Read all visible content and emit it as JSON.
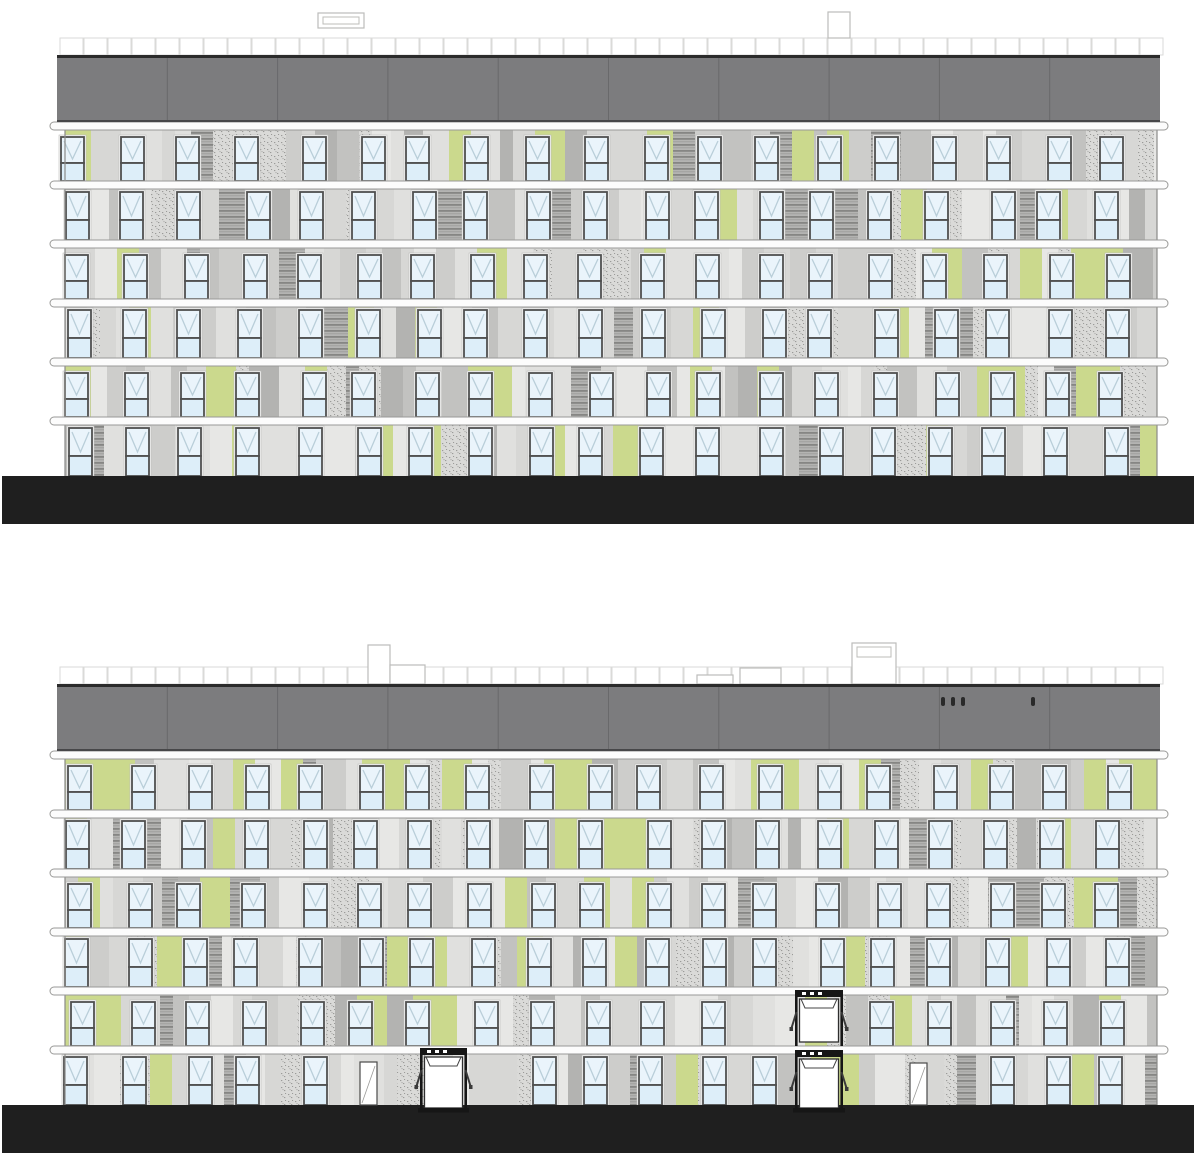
{
  "canvas": {
    "width": 1200,
    "height": 1166,
    "background": "#ffffff"
  },
  "colors": {
    "roof_fill": "#7c7c7e",
    "roof_top_edge": "#2b2b2b",
    "roof_seam": "#69696b",
    "roof_bottom_edge": "#474749",
    "slab_fill": "#fcfcfc",
    "slab_stroke": "#999997",
    "facade_base": "#dcdcda",
    "facade_edge": "#8a8a88",
    "panel_grays": [
      "#e7e7e5",
      "#e0e0de",
      "#d7d7d5",
      "#cdcdcb",
      "#c2c2c0",
      "#b3b3b1"
    ],
    "green": "#cbd98d",
    "stipple_bg": "#dadad8",
    "stipple_dot": "#9b9b99",
    "stripe_bg": "#b4b4b2",
    "stripe_line": "#868684",
    "window_frame": "#4f4f4f",
    "window_pane": "#eaf4fb",
    "window_pane_lower": "#ddeef9",
    "window_mark": "#b9ced9",
    "window_surround": "#f7f7f7",
    "parapet_stroke": "#d4d4d2",
    "ground_fill": "#1f1f1f",
    "entrance_dark": "#161616",
    "entrance_body": "#ffffff",
    "entrance_stroke": "#2e2e2e",
    "door_fill": "#ffffff",
    "door_stroke": "#4a4a4a",
    "vent_stroke": "#bcbcba"
  },
  "geometry": {
    "roof": {
      "x": 57,
      "width": 1103,
      "height": 67,
      "segments": 10
    },
    "facade": {
      "x": 65,
      "width": 1092,
      "top": 67,
      "bottom": 421
    },
    "slab": {
      "x": 50,
      "width": 1118,
      "height": 8,
      "first_y": 67,
      "spacing": 59,
      "count": 6
    },
    "floor_count": 6,
    "band_height": 51,
    "window": {
      "width": 23,
      "heights": [
        44,
        48
      ],
      "spacing": 57.4,
      "start_x": 68,
      "per_row": 19
    },
    "parapet": {
      "y": -17,
      "height": 17,
      "square_width": 24
    },
    "ground": {
      "x": 2,
      "width": 1192,
      "height": 48,
      "y": 421
    }
  },
  "buildings": [
    {
      "name": "upper-elevation",
      "origin_y": 55,
      "seed": 7,
      "vents": [
        {
          "x": 318,
          "dy": -42,
          "width": 46,
          "height": 15,
          "inner": true
        },
        {
          "x": 828,
          "dy": -43,
          "width": 22,
          "height": 26
        }
      ],
      "roof_dots": [],
      "entrances": [],
      "doors": [],
      "window_skips": {}
    },
    {
      "name": "lower-elevation",
      "origin_y": 684,
      "seed": 13,
      "vents": [
        {
          "x": 368,
          "dy": -39,
          "width": 22,
          "height": 39
        },
        {
          "x": 390,
          "dy": -19,
          "width": 35,
          "height": 19
        },
        {
          "x": 697,
          "dy": -9,
          "width": 36,
          "height": 9
        },
        {
          "x": 740,
          "dy": -16,
          "width": 41,
          "height": 16
        },
        {
          "x": 852,
          "dy": -41,
          "width": 44,
          "height": 41,
          "inner": true
        }
      ],
      "roof_dots": [
        {
          "x": 941,
          "dy": 13
        },
        {
          "x": 951,
          "dy": 13
        },
        {
          "x": 961,
          "dy": 13
        },
        {
          "x": 1031,
          "dy": 13
        }
      ],
      "entrances": [
        {
          "x": 420,
          "y": 1048,
          "width": 47,
          "height": 64,
          "ground": true
        },
        {
          "x": 795,
          "y": 990,
          "width": 48,
          "height": 56,
          "ground": false
        },
        {
          "x": 795,
          "y": 1050,
          "width": 48,
          "height": 62,
          "ground": true
        }
      ],
      "doors": [
        {
          "x": 360,
          "y": 1062,
          "width": 17,
          "height": 43
        },
        {
          "x": 910,
          "y": 1063,
          "width": 17,
          "height": 42
        }
      ],
      "window_skips": {
        "4": [
          [
            780,
            855
          ]
        ],
        "5": [
          [
            345,
            480
          ],
          [
            780,
            945
          ]
        ]
      }
    }
  ]
}
